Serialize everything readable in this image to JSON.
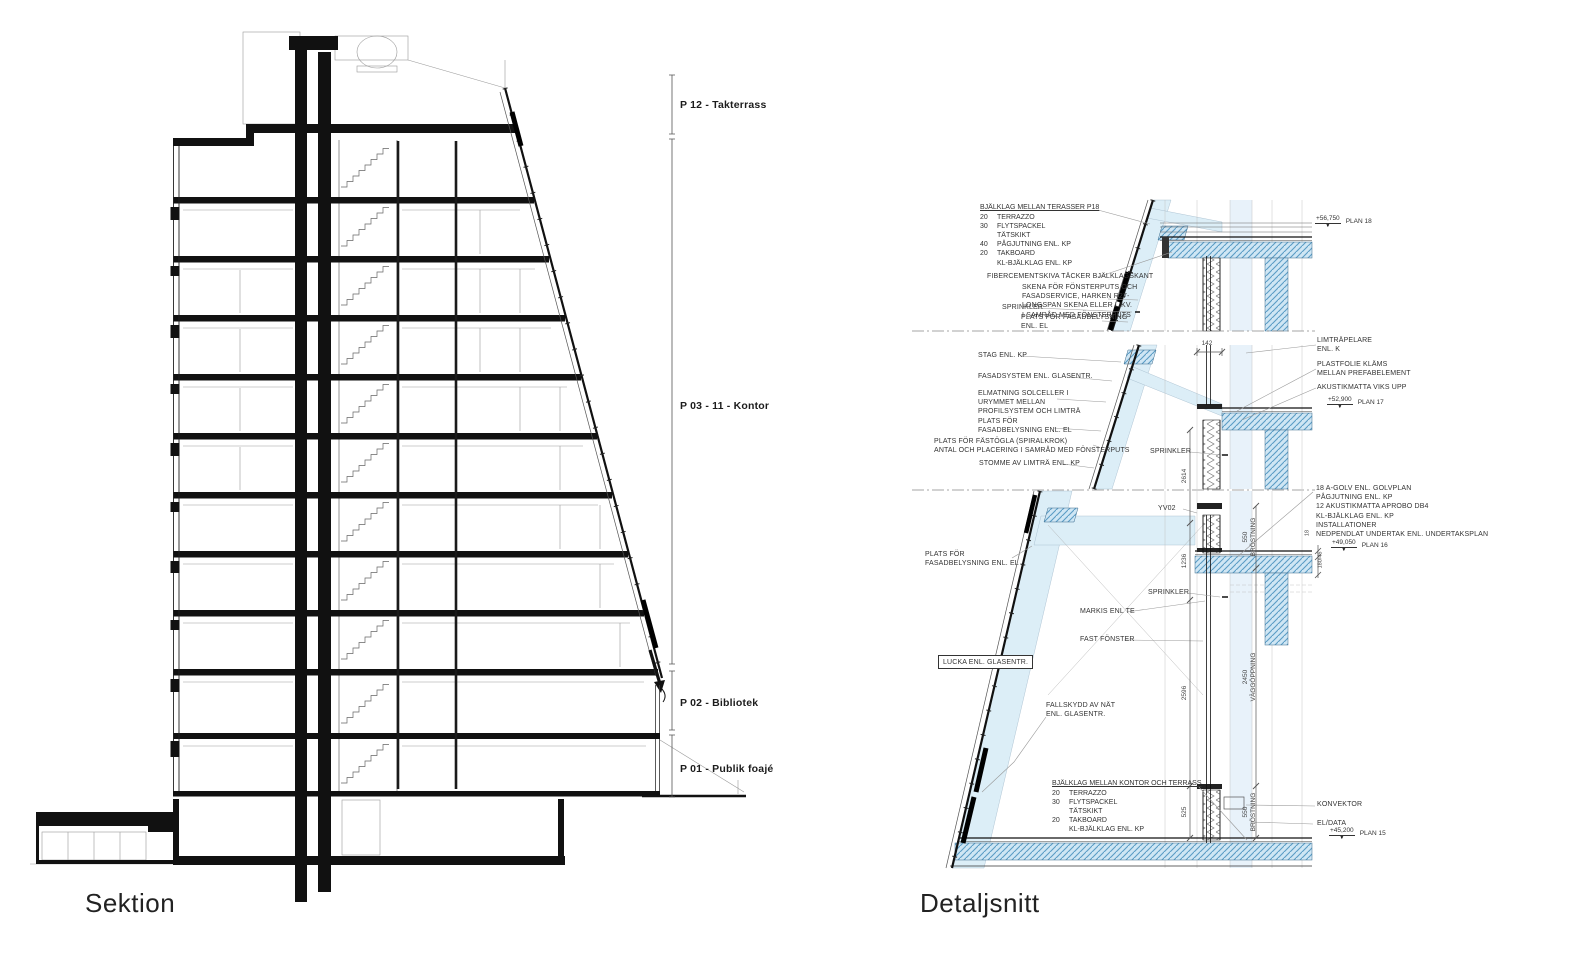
{
  "titles": {
    "section": "Sektion",
    "detail": "Detaljsnitt"
  },
  "section_levels": [
    {
      "label": "P 12 - Takterrass"
    },
    {
      "label": "P 03 - 11 - Kontor"
    },
    {
      "label": "P 02 - Bibliotek"
    },
    {
      "label": "P 01 - Publik foajé"
    }
  ],
  "detail": {
    "slab_top": {
      "title": "BJÄLKLAG MELLAN TERASSER P18",
      "layers": [
        {
          "num": "20",
          "text": "TERRAZZO"
        },
        {
          "num": "30",
          "text": "FLYTSPACKEL"
        },
        {
          "num": "",
          "text": "TÄTSKIKT"
        },
        {
          "num": "40",
          "text": "PÅGJUTNING ENL. KP"
        },
        {
          "num": "20",
          "text": "TAKBOARD"
        },
        {
          "num": "",
          "text": "KL-BJÄLKLAG ENL. KP"
        }
      ]
    },
    "slab_bottom": {
      "title": "BJÄLKLAG MELLAN KONTOR OCH TERRASS",
      "layers": [
        {
          "num": "20",
          "text": "TERRAZZO"
        },
        {
          "num": "30",
          "text": "FLYTSPACKEL"
        },
        {
          "num": "",
          "text": "TÄTSKIKT"
        },
        {
          "num": "20",
          "text": "TAKBOARD"
        },
        {
          "num": "",
          "text": "KL-BJÄLKLAG ENL. KP"
        }
      ]
    },
    "callouts": {
      "fibercement": "FIBERCEMENTSKIVA TÄCKER BJÄLKLAGSKANT",
      "skena": "SKENA FÖR FÖNSTERPUTS OCH\nFASADSERVICE, HARKEN R27-\nLONGSPAN SKENA ELLER LIKV.\nI SAMRÅD MED FÖNSTERPUTS",
      "sprinkler_1": "SPRINKLER",
      "fasadbelysning_1": "PLATS FÖR FASADBELYSNING\nENL. EL",
      "stag": "STAG ENL. KP",
      "fasadsystem": "FASADSYSTEM ENL. GLASENTR.",
      "elmatning": "ELMATNING SOLCELLER I\nURYMMET MELLAN\nPROFILSYSTEM OCH LIMTRÄ",
      "fasadbelysning_2": "PLATS FÖR\nFASADBELYSNING ENL. EL",
      "fastogla": "PLATS FÖR FÄSTÖGLA (SPIRALKROK)\nANTAL OCH PLACERING I SAMRÅD MED FÖNSTERPUTS",
      "stomme": "STOMME AV LIMTRÄ ENL. KP",
      "sprinkler_2": "SPRINKLER",
      "yv02": "YV02",
      "fasadbelysning_3": "PLATS FÖR\nFASADBELYSNING ENL. EL",
      "sprinkler_3": "SPRINKLER",
      "markis": "MARKIS ENL TE",
      "fast_fonster": "FAST FÖNSTER",
      "lucka": "LUCKA ENL. GLASENTR.",
      "fallskydd": "FALLSKYDD AV NÄT\nENL. GLASENTR.",
      "limtrapelar": "LIMTRÄPELARE\nENL. K",
      "plastfolie": "PLASTFOLIE KLÄMS\nMELLAN PREFABELEMENT",
      "akustikmatta": "AKUSTIKMATTA VIKS UPP",
      "golv_block": "18 A-GOLV ENL. GOLVPLAN\nPÅGJUTNING ENL. KP\n12 AKUSTIKMATTA APROBO DB4\nKL-BJÄLKLAG ENL. KP\nINSTALLATIONER\nNEDPENDLAT UNDERTAK ENL. UNDERTAKSPLAN",
      "konvektor": "KONVEKTOR",
      "eldata": "EL/DATA"
    },
    "levels": [
      {
        "elevation": "+56,750",
        "plan": "PLAN 18"
      },
      {
        "elevation": "+52,900",
        "plan": "PLAN 17"
      },
      {
        "elevation": "+49,050",
        "plan": "PLAN 16"
      },
      {
        "elevation": "+45,200",
        "plan": "PLAN 15"
      }
    ],
    "dimensions": {
      "d142": "142",
      "d2614": "2614",
      "d1236": "1236",
      "d2596": "2596",
      "d525": "525",
      "brostning_1": "550\nBRÖSTNING",
      "vaggoppning": "2450\nVÄGGÖPPNING",
      "brostning_2": "550\nBRÖSTNING",
      "d18": "18",
      "d180": "180/45"
    }
  }
}
